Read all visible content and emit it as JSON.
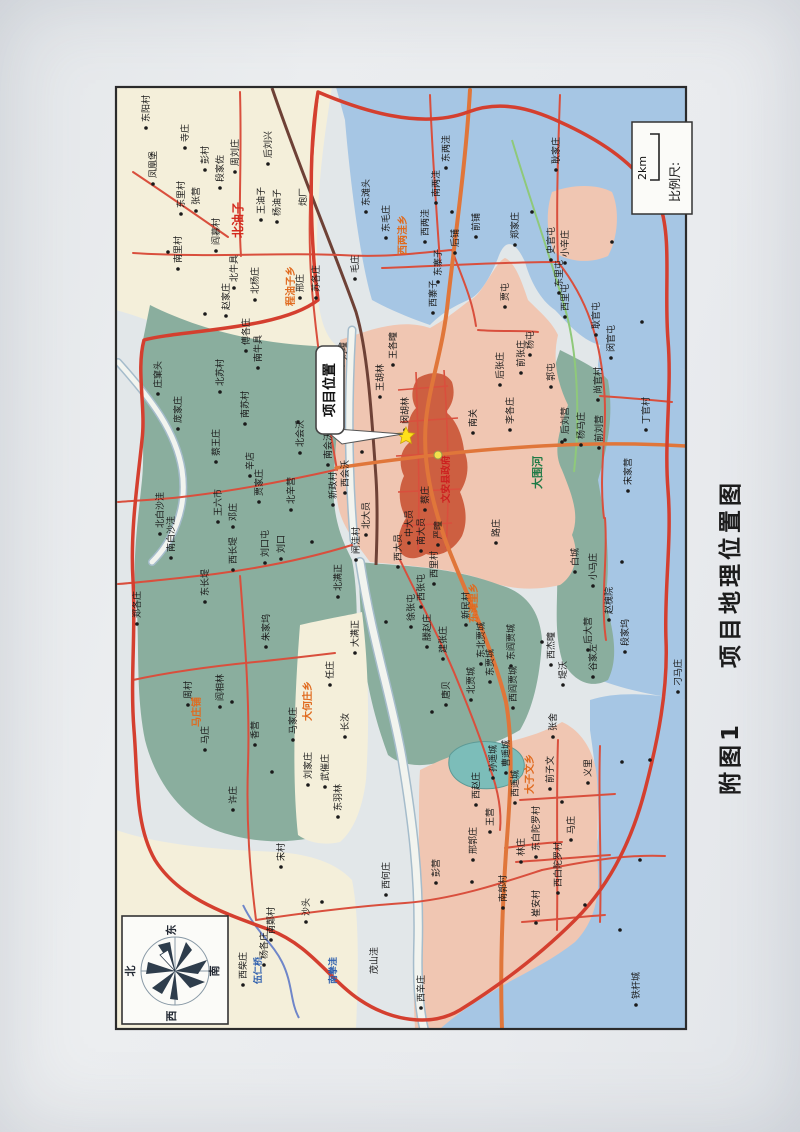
{
  "caption": {
    "figure_no": "附图1",
    "title": "项目地理位置图"
  },
  "scale_box": {
    "label": "比例尺:",
    "value": "2km"
  },
  "compass": {
    "top": "东",
    "bottom": "西",
    "left": "北",
    "right": "南"
  },
  "callout": {
    "text": "项目位置"
  },
  "county_seat": {
    "gov_label": "文安县政府"
  },
  "palette": {
    "paper": "#e9ebed",
    "map_bg": "#e2e7e9",
    "cream": "#f4efda",
    "blue": "#a6c6e4",
    "green": "#8aae9e",
    "pink": "#f0c6b2",
    "urban": "#cd5f41",
    "lake": "#7cbdb9",
    "road_red": "#d94f3d",
    "road_orange": "#e0763a",
    "boundary": "#d43f2f",
    "rail": "#6e4136",
    "river_fill": "#f2f4ef",
    "river_edge": "#a5bccb",
    "canal": "#8fc97a",
    "creek": "#6f86c9",
    "frame": "#2b2b2b",
    "box_bg": "#fbfbf8",
    "ink": "#1a1a1a",
    "township": "#e06a1e",
    "town_red": "#d42a1e",
    "water_text": "#2e5fae",
    "green_text": "#1e7a46",
    "gov_red": "#cc1f1f",
    "compass_petal": "#2e3d4c",
    "star_fill": "#ffe01a",
    "star_edge": "#caa50a",
    "gov_dot": "#f3e14c"
  },
  "map": {
    "kinds": {
      "v": {
        "size": 9,
        "color_key": "ink",
        "dot": true
      },
      "n": {
        "size": 9,
        "color_key": "ink",
        "dot": false
      },
      "t": {
        "size": 10,
        "color_key": "township",
        "dot": false,
        "weight": "bold"
      },
      "T": {
        "size": 12,
        "color_key": "town_red",
        "dot": false,
        "weight": "bold"
      },
      "w": {
        "size": 9,
        "color_key": "water_text",
        "dot": false,
        "weight": "bold"
      },
      "g": {
        "size": 11,
        "color_key": "green_text",
        "dot": false,
        "weight": "bold"
      },
      "r": {
        "size": 9.5,
        "color_key": "gov_red",
        "dot": false,
        "weight": "bold"
      }
    },
    "labels": [
      {
        "t": "东阳村",
        "x": 149,
        "y": 122,
        "k": "v"
      },
      {
        "t": "寺庄",
        "x": 188,
        "y": 142,
        "k": "v"
      },
      {
        "t": "凤凰堡",
        "x": 156,
        "y": 178,
        "k": "v"
      },
      {
        "t": "彭村",
        "x": 208,
        "y": 164,
        "k": "v"
      },
      {
        "t": "段家佐",
        "x": 223,
        "y": 182,
        "k": "v"
      },
      {
        "t": "周刘庄",
        "x": 238,
        "y": 166,
        "k": "v"
      },
      {
        "t": "后刘兴",
        "x": 271,
        "y": 158,
        "k": "v"
      },
      {
        "t": "张营",
        "x": 199,
        "y": 205,
        "k": "v"
      },
      {
        "t": "东里村",
        "x": 184,
        "y": 208,
        "k": "v"
      },
      {
        "t": "南里村",
        "x": 181,
        "y": 263,
        "k": "v"
      },
      {
        "t": "阎慕村",
        "x": 219,
        "y": 245,
        "k": "v"
      },
      {
        "t": "赵家庄",
        "x": 229,
        "y": 310,
        "k": "v"
      },
      {
        "t": "王油子",
        "x": 264,
        "y": 214,
        "k": "v"
      },
      {
        "t": "杨油子",
        "x": 280,
        "y": 216,
        "k": "v"
      },
      {
        "t": "北油子",
        "x": 242,
        "y": 238,
        "k": "T"
      },
      {
        "t": "程油子乡",
        "x": 294,
        "y": 306,
        "k": "t"
      },
      {
        "t": "炮厂",
        "x": 306,
        "y": 206,
        "k": "n"
      },
      {
        "t": "北牛具",
        "x": 237,
        "y": 282,
        "k": "v"
      },
      {
        "t": "北杨庄",
        "x": 258,
        "y": 294,
        "k": "v"
      },
      {
        "t": "邢庄",
        "x": 303,
        "y": 292,
        "k": "v"
      },
      {
        "t": "苏各庄",
        "x": 319,
        "y": 292,
        "k": "v"
      },
      {
        "t": "南牛具",
        "x": 261,
        "y": 362,
        "k": "v"
      },
      {
        "t": "傅各庄",
        "x": 249,
        "y": 345,
        "k": "v"
      },
      {
        "t": "北苏村",
        "x": 223,
        "y": 386,
        "k": "v"
      },
      {
        "t": "南苏村",
        "x": 248,
        "y": 418,
        "k": "v"
      },
      {
        "t": "庄窠头",
        "x": 161,
        "y": 388,
        "k": "v"
      },
      {
        "t": "庞家庄",
        "x": 181,
        "y": 423,
        "k": "v"
      },
      {
        "t": "北白沙洼",
        "x": 163,
        "y": 528,
        "k": "v"
      },
      {
        "t": "南白沙洼",
        "x": 174,
        "y": 552,
        "k": "v"
      },
      {
        "t": "蔡王庄",
        "x": 219,
        "y": 456,
        "k": "v"
      },
      {
        "t": "辛店",
        "x": 253,
        "y": 470,
        "k": "v"
      },
      {
        "t": "贾家庄",
        "x": 262,
        "y": 496,
        "k": "v"
      },
      {
        "t": "王六市",
        "x": 221,
        "y": 516,
        "k": "v"
      },
      {
        "t": "邓庄",
        "x": 236,
        "y": 521,
        "k": "v"
      },
      {
        "t": "北辛营",
        "x": 294,
        "y": 504,
        "k": "v"
      },
      {
        "t": "刘口屯",
        "x": 268,
        "y": 557,
        "k": "v"
      },
      {
        "t": "刘口",
        "x": 284,
        "y": 553,
        "k": "v"
      },
      {
        "t": "西长堤",
        "x": 236,
        "y": 564,
        "k": "v"
      },
      {
        "t": "东长堤",
        "x": 208,
        "y": 596,
        "k": "v"
      },
      {
        "t": "郑各庄",
        "x": 140,
        "y": 618,
        "k": "v"
      },
      {
        "t": "朱家坞",
        "x": 269,
        "y": 641,
        "k": "v"
      },
      {
        "t": "北会沃",
        "x": 303,
        "y": 447,
        "k": "v"
      },
      {
        "t": "南会沃",
        "x": 331,
        "y": 459,
        "k": "v"
      },
      {
        "t": "新政村",
        "x": 336,
        "y": 499,
        "k": "v"
      },
      {
        "t": "西会沃",
        "x": 348,
        "y": 487,
        "k": "v"
      },
      {
        "t": "大何庄乡",
        "x": 311,
        "y": 721,
        "k": "t"
      },
      {
        "t": "任庄",
        "x": 333,
        "y": 679,
        "k": "v"
      },
      {
        "t": "长汝",
        "x": 348,
        "y": 731,
        "k": "v"
      },
      {
        "t": "马家庄",
        "x": 296,
        "y": 734,
        "k": "v"
      },
      {
        "t": "香营",
        "x": 258,
        "y": 739,
        "k": "v"
      },
      {
        "t": "刘家庄",
        "x": 311,
        "y": 779,
        "k": "v"
      },
      {
        "t": "武催庄",
        "x": 328,
        "y": 781,
        "k": "v"
      },
      {
        "t": "东羽林",
        "x": 341,
        "y": 811,
        "k": "v"
      },
      {
        "t": "许庄",
        "x": 236,
        "y": 804,
        "k": "v"
      },
      {
        "t": "周村",
        "x": 191,
        "y": 699,
        "k": "v"
      },
      {
        "t": "阎相林",
        "x": 223,
        "y": 701,
        "k": "v"
      },
      {
        "t": "马庄铺",
        "x": 200,
        "y": 727,
        "k": "t"
      },
      {
        "t": "马庄",
        "x": 208,
        "y": 744,
        "k": "v"
      },
      {
        "t": "北满正",
        "x": 341,
        "y": 591,
        "k": "v"
      },
      {
        "t": "大满正",
        "x": 358,
        "y": 647,
        "k": "v"
      },
      {
        "t": "新民村",
        "x": 469,
        "y": 619,
        "k": "v"
      },
      {
        "t": "徐张屯",
        "x": 414,
        "y": 621,
        "k": "v"
      },
      {
        "t": "西张屯",
        "x": 424,
        "y": 601,
        "k": "v"
      },
      {
        "t": "西里村",
        "x": 437,
        "y": 578,
        "k": "v"
      },
      {
        "t": "滕赵庄",
        "x": 430,
        "y": 641,
        "k": "v"
      },
      {
        "t": "建张庄",
        "x": 446,
        "y": 653,
        "k": "v"
      },
      {
        "t": "唐贝",
        "x": 449,
        "y": 699,
        "k": "v"
      },
      {
        "t": "北贾城",
        "x": 474,
        "y": 694,
        "k": "v"
      },
      {
        "t": "东贾城",
        "x": 493,
        "y": 676,
        "k": "v"
      },
      {
        "t": "东北贾城",
        "x": 484,
        "y": 658,
        "k": "v"
      },
      {
        "t": "东阎贾城",
        "x": 514,
        "y": 660,
        "k": "v"
      },
      {
        "t": "西阎贾城",
        "x": 516,
        "y": 702,
        "k": "v"
      },
      {
        "t": "东滩里乡",
        "x": 477,
        "y": 623,
        "k": "t"
      },
      {
        "t": "堤沃",
        "x": 566,
        "y": 679,
        "k": "v"
      },
      {
        "t": "西杰疃",
        "x": 554,
        "y": 659,
        "k": "v"
      },
      {
        "t": "谷家左",
        "x": 596,
        "y": 671,
        "k": "v"
      },
      {
        "t": "后大营",
        "x": 591,
        "y": 644,
        "k": "v"
      },
      {
        "t": "段家坞",
        "x": 628,
        "y": 646,
        "k": "v"
      },
      {
        "t": "赵槐院",
        "x": 612,
        "y": 614,
        "k": "v"
      },
      {
        "t": "小马庄",
        "x": 596,
        "y": 580,
        "k": "v"
      },
      {
        "t": "白城",
        "x": 578,
        "y": 566,
        "k": "v"
      },
      {
        "t": "刁马庄",
        "x": 681,
        "y": 686,
        "k": "v"
      },
      {
        "t": "北大员",
        "x": 369,
        "y": 529,
        "k": "v"
      },
      {
        "t": "闸洼村",
        "x": 359,
        "y": 554,
        "k": "v"
      },
      {
        "t": "西大员",
        "x": 401,
        "y": 561,
        "k": "v"
      },
      {
        "t": "中大员",
        "x": 412,
        "y": 537,
        "k": "v"
      },
      {
        "t": "南大员",
        "x": 424,
        "y": 545,
        "k": "v"
      },
      {
        "t": "蔡庄",
        "x": 428,
        "y": 504,
        "k": "v"
      },
      {
        "t": "严疃",
        "x": 441,
        "y": 539,
        "k": "v"
      },
      {
        "t": "路庄",
        "x": 499,
        "y": 537,
        "k": "v"
      },
      {
        "t": "李疃",
        "x": 341,
        "y": 394,
        "k": "v"
      },
      {
        "t": "彭疃",
        "x": 329,
        "y": 367,
        "k": "v"
      },
      {
        "t": "刘疃",
        "x": 346,
        "y": 360,
        "k": "v"
      },
      {
        "t": "王各疃",
        "x": 396,
        "y": 359,
        "k": "v"
      },
      {
        "t": "王胡林",
        "x": 383,
        "y": 391,
        "k": "v"
      },
      {
        "t": "闵胡林",
        "x": 408,
        "y": 424,
        "k": "v"
      },
      {
        "t": "后张庄",
        "x": 503,
        "y": 379,
        "k": "v"
      },
      {
        "t": "前张庄",
        "x": 524,
        "y": 367,
        "k": "v"
      },
      {
        "t": "杨屯",
        "x": 533,
        "y": 349,
        "k": "v"
      },
      {
        "t": "郭屯",
        "x": 554,
        "y": 381,
        "k": "v"
      },
      {
        "t": "南关",
        "x": 476,
        "y": 427,
        "k": "v"
      },
      {
        "t": "李各庄",
        "x": 513,
        "y": 424,
        "k": "v"
      },
      {
        "t": "后刘营",
        "x": 568,
        "y": 434,
        "k": "v"
      },
      {
        "t": "杨马庄",
        "x": 584,
        "y": 439,
        "k": "v"
      },
      {
        "t": "前刘营",
        "x": 602,
        "y": 442,
        "k": "v"
      },
      {
        "t": "尚官村",
        "x": 601,
        "y": 394,
        "k": "v"
      },
      {
        "t": "宋家营",
        "x": 631,
        "y": 485,
        "k": "v"
      },
      {
        "t": "丁官村",
        "x": 649,
        "y": 424,
        "k": "v"
      },
      {
        "t": "大围河",
        "x": 541,
        "y": 489,
        "k": "g"
      },
      {
        "t": "文安县政府",
        "x": 449,
        "y": 503,
        "k": "r"
      },
      {
        "t": "东毛庄",
        "x": 389,
        "y": 232,
        "k": "v"
      },
      {
        "t": "毛庄",
        "x": 358,
        "y": 273,
        "k": "v"
      },
      {
        "t": "东滩头",
        "x": 369,
        "y": 206,
        "k": "v"
      },
      {
        "t": "西两洼乡",
        "x": 406,
        "y": 255,
        "k": "t"
      },
      {
        "t": "西两洼",
        "x": 428,
        "y": 236,
        "k": "v"
      },
      {
        "t": "东寨子",
        "x": 441,
        "y": 276,
        "k": "v"
      },
      {
        "t": "西寨子",
        "x": 436,
        "y": 307,
        "k": "v"
      },
      {
        "t": "东两洼",
        "x": 449,
        "y": 162,
        "k": "v"
      },
      {
        "t": "南两洼",
        "x": 439,
        "y": 197,
        "k": "v"
      },
      {
        "t": "前铺",
        "x": 479,
        "y": 231,
        "k": "v"
      },
      {
        "t": "后铺",
        "x": 458,
        "y": 247,
        "k": "v"
      },
      {
        "t": "郑家庄",
        "x": 518,
        "y": 239,
        "k": "v"
      },
      {
        "t": "史官屯",
        "x": 554,
        "y": 254,
        "k": "v"
      },
      {
        "t": "小辛庄",
        "x": 568,
        "y": 257,
        "k": "v"
      },
      {
        "t": "东里屯",
        "x": 562,
        "y": 287,
        "k": "v"
      },
      {
        "t": "西里屯",
        "x": 568,
        "y": 311,
        "k": "v"
      },
      {
        "t": "贾屯",
        "x": 508,
        "y": 301,
        "k": "v"
      },
      {
        "t": "耿官屯",
        "x": 599,
        "y": 329,
        "k": "v"
      },
      {
        "t": "闵官屯",
        "x": 614,
        "y": 352,
        "k": "v"
      },
      {
        "t": "耿家庄",
        "x": 559,
        "y": 164,
        "k": "v"
      },
      {
        "t": "大子文乡",
        "x": 533,
        "y": 794,
        "k": "t"
      },
      {
        "t": "前子文",
        "x": 553,
        "y": 783,
        "k": "v"
      },
      {
        "t": "义里",
        "x": 591,
        "y": 777,
        "k": "v"
      },
      {
        "t": "西赵庄",
        "x": 479,
        "y": 799,
        "k": "v"
      },
      {
        "t": "西遥城",
        "x": 518,
        "y": 797,
        "k": "v"
      },
      {
        "t": "孙遥城",
        "x": 496,
        "y": 772,
        "k": "v"
      },
      {
        "t": "曹遥城",
        "x": 509,
        "y": 767,
        "k": "v"
      },
      {
        "t": "张舍",
        "x": 556,
        "y": 731,
        "k": "v"
      },
      {
        "t": "东白陀罗村",
        "x": 539,
        "y": 851,
        "k": "v"
      },
      {
        "t": "西白陀罗村",
        "x": 561,
        "y": 887,
        "k": "v"
      },
      {
        "t": "林庄",
        "x": 524,
        "y": 856,
        "k": "v"
      },
      {
        "t": "王营",
        "x": 493,
        "y": 826,
        "k": "v"
      },
      {
        "t": "邢郭庄",
        "x": 476,
        "y": 854,
        "k": "v"
      },
      {
        "t": "南郭村",
        "x": 506,
        "y": 902,
        "k": "v"
      },
      {
        "t": "崔安村",
        "x": 539,
        "y": 917,
        "k": "v"
      },
      {
        "t": "马庄",
        "x": 574,
        "y": 834,
        "k": "v"
      },
      {
        "t": "铁杆城",
        "x": 639,
        "y": 999,
        "k": "v"
      },
      {
        "t": "彭营",
        "x": 439,
        "y": 877,
        "k": "v"
      },
      {
        "t": "南鄚村",
        "x": 274,
        "y": 934,
        "k": "v"
      },
      {
        "t": "宋村",
        "x": 284,
        "y": 861,
        "k": "v"
      },
      {
        "t": "西何庄",
        "x": 389,
        "y": 889,
        "k": "v"
      },
      {
        "t": "沙头",
        "x": 309,
        "y": 916,
        "k": "v"
      },
      {
        "t": "茂山洼",
        "x": 377,
        "y": 974,
        "k": "n"
      },
      {
        "t": "南拳洼",
        "x": 336,
        "y": 984,
        "k": "w"
      },
      {
        "t": "伍仁桥",
        "x": 261,
        "y": 984,
        "k": "w"
      },
      {
        "t": "西柴庄",
        "x": 246,
        "y": 979,
        "k": "v"
      },
      {
        "t": "杨各庄",
        "x": 267,
        "y": 959,
        "k": "v"
      },
      {
        "t": "西辛庄",
        "x": 424,
        "y": 1002,
        "k": "v"
      }
    ],
    "extra_dots": [
      [
        168,
        252
      ],
      [
        205,
        314
      ],
      [
        298,
        422
      ],
      [
        312,
        542
      ],
      [
        232,
        702
      ],
      [
        272,
        772
      ],
      [
        322,
        902
      ],
      [
        452,
        212
      ],
      [
        532,
        212
      ],
      [
        612,
        242
      ],
      [
        642,
        322
      ],
      [
        562,
        442
      ],
      [
        622,
        562
      ],
      [
        542,
        642
      ],
      [
        472,
        882
      ],
      [
        562,
        802
      ],
      [
        622,
        762
      ],
      [
        362,
        452
      ],
      [
        386,
        622
      ],
      [
        432,
        712
      ],
      [
        585,
        905
      ],
      [
        640,
        860
      ],
      [
        650,
        760
      ],
      [
        620,
        930
      ]
    ]
  }
}
